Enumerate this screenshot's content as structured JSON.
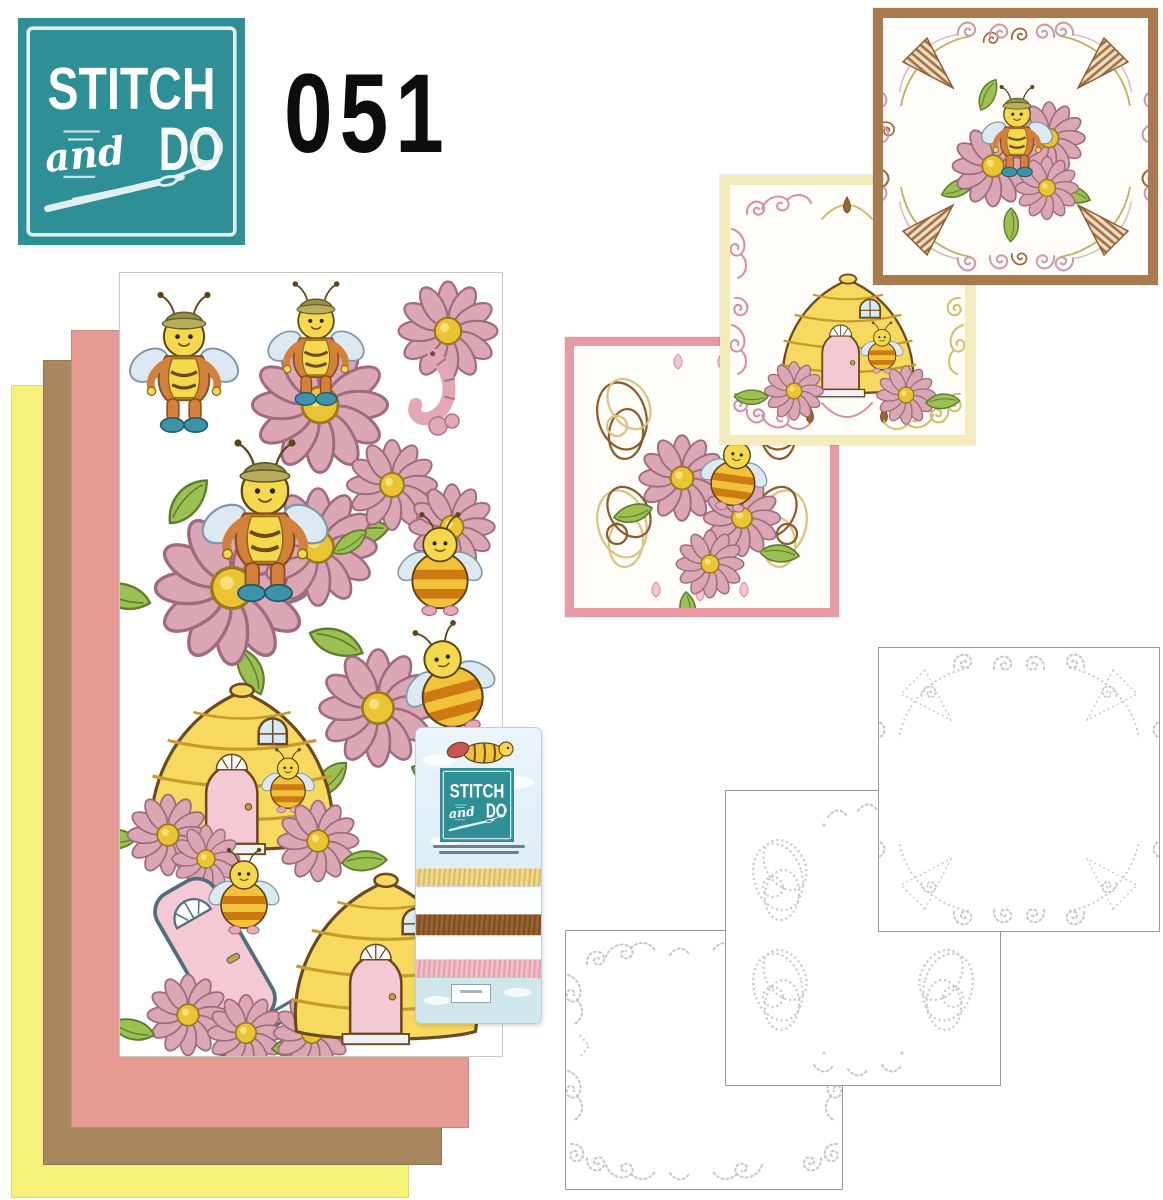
{
  "brand": {
    "word_top": "STITCH",
    "word_mid": "and",
    "word_bottom": "DO"
  },
  "edition": {
    "number": "051"
  },
  "colors": {
    "logo_teal": "#2e8f96",
    "sheet_yellow": "#f6f17b",
    "sheet_brown": "#a8875f",
    "sheet_pink": "#e79a92",
    "card_border_brown": "#a87a4e",
    "card_border_yellow": "#f4edbb",
    "card_border_pink": "#e59ba1",
    "thread_gold": "#e7d07e",
    "thread_brown": "#8e5a2c",
    "thread_pink": "#f0b6c0",
    "template_stitch_gray": "#c7c7c7"
  },
  "paper_stack": {
    "sheets": [
      {
        "name": "yellow cardstock"
      },
      {
        "name": "brown cardstock"
      },
      {
        "name": "pink cardstock"
      },
      {
        "name": "bee decoupage sheet"
      }
    ]
  },
  "thread_pack": {
    "thread_names": [
      "gold",
      "brown",
      "pink"
    ]
  },
  "finished_cards": [
    {
      "name": "brown framed card",
      "motif": "bee on flowers"
    },
    {
      "name": "yellow framed card",
      "motif": "beehive"
    },
    {
      "name": "pink framed card",
      "motif": "bee with flowers"
    }
  ],
  "templates": [
    {
      "name": "fan corner stitching template"
    },
    {
      "name": "interlocked loops stitching template"
    },
    {
      "name": "scroll border stitching template"
    }
  ]
}
